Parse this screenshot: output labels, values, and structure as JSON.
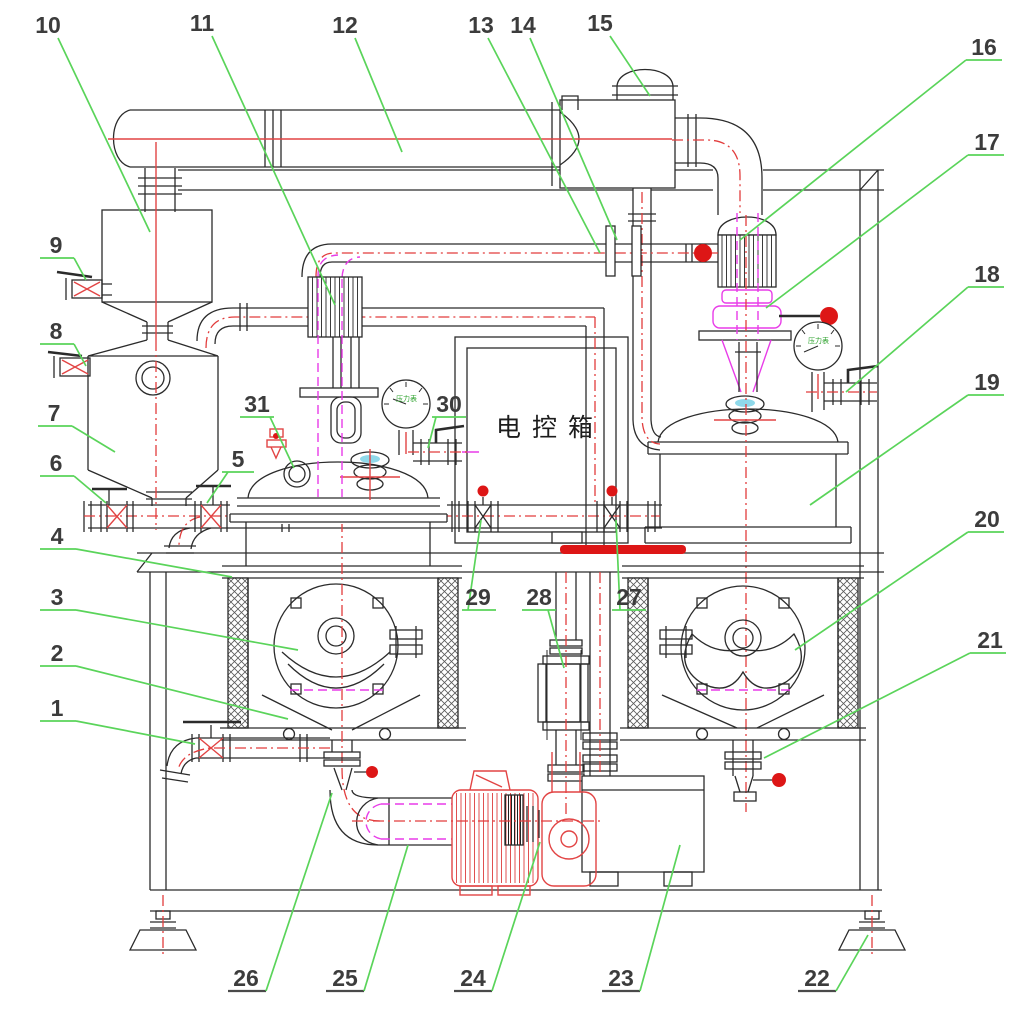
{
  "diagram": {
    "control_box_label": "电控箱",
    "gauge_label_left": "压力表",
    "gauge_label_right": "压力表",
    "callouts": [
      "1",
      "2",
      "3",
      "4",
      "5",
      "6",
      "7",
      "8",
      "9",
      "10",
      "11",
      "12",
      "13",
      "14",
      "15",
      "16",
      "17",
      "18",
      "19",
      "20",
      "21",
      "22",
      "23",
      "24",
      "25",
      "26",
      "27",
      "28",
      "29",
      "30",
      "31"
    ]
  },
  "colors": {
    "line": "#2b2b2b",
    "centerline_red": "#e23c3c",
    "solid_red_fill": "#dd1616",
    "emphasis_bar_red": "#e01212",
    "magenta": "#e83ce8",
    "leader_green": "#5ad45a",
    "sight_glass_cyan": "#8fd9ea",
    "label_text": "#3c3c3c"
  }
}
